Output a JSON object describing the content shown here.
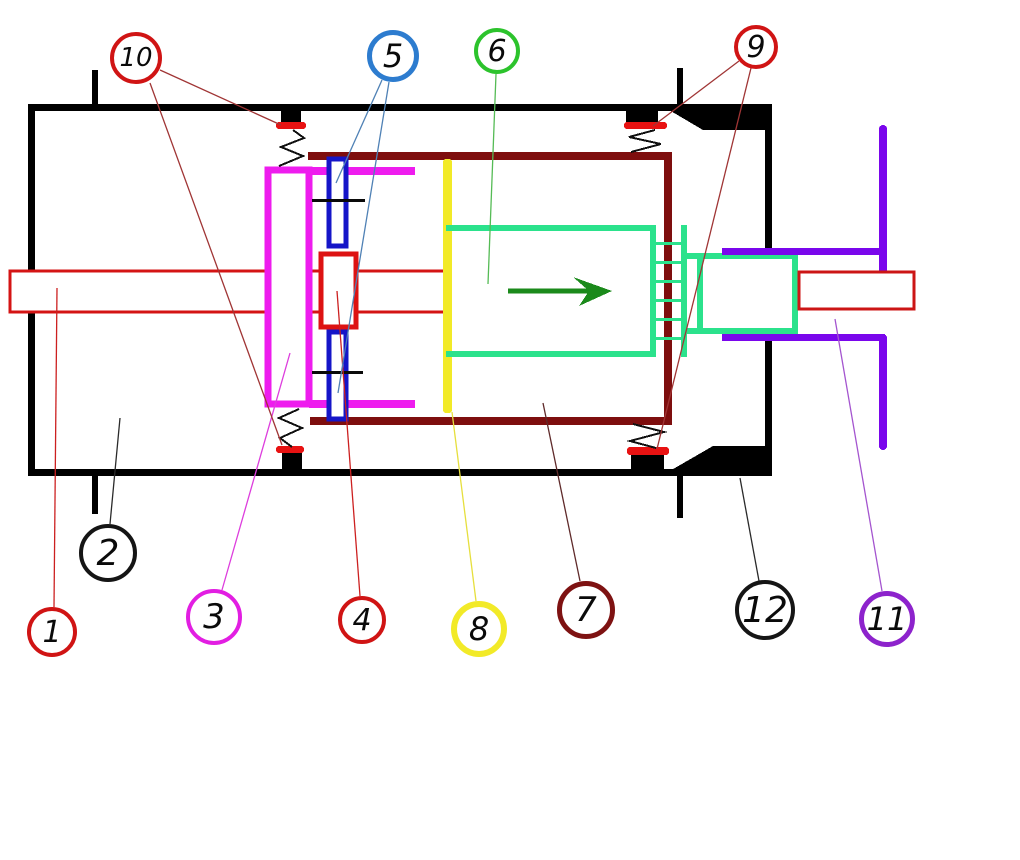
{
  "diagram": {
    "kind": "hand-drawn cylinder cross-section schematic with numbered callouts",
    "background": "#ffffff",
    "arrow": {
      "direction": "right",
      "color": "#1b8a1b"
    },
    "palette": {
      "housing_black": "#000000",
      "seal_red": "#e81212",
      "inner_cylinder_dark_red": "#7e0e0e",
      "rod_red": "#d41414",
      "yoke_magenta": "#ee1cee",
      "guide_blue": "#1515c8",
      "disc_yellow": "#f2ea28",
      "piston_spring_green": "#2be28c",
      "guide_purple": "#7a06ec",
      "leader_dark_red": "#a03535",
      "leader_steel_blue": "#4f81b5",
      "leader_green": "#55bb55",
      "leader_violet": "#a455cf"
    },
    "callouts": [
      {
        "number": "1",
        "color": "#d01414"
      },
      {
        "number": "2",
        "color": "#151515"
      },
      {
        "number": "3",
        "color": "#e21ee2"
      },
      {
        "number": "4",
        "color": "#d01414"
      },
      {
        "number": "5",
        "color": "#2d7ccf"
      },
      {
        "number": "6",
        "color": "#2cc32c"
      },
      {
        "number": "7",
        "color": "#7e1212"
      },
      {
        "number": "8",
        "color": "#f2ea28"
      },
      {
        "number": "9",
        "color": "#d01414"
      },
      {
        "number": "10",
        "color": "#d01414"
      },
      {
        "number": "11",
        "color": "#8d23cc"
      },
      {
        "number": "12",
        "color": "#151515"
      }
    ]
  }
}
